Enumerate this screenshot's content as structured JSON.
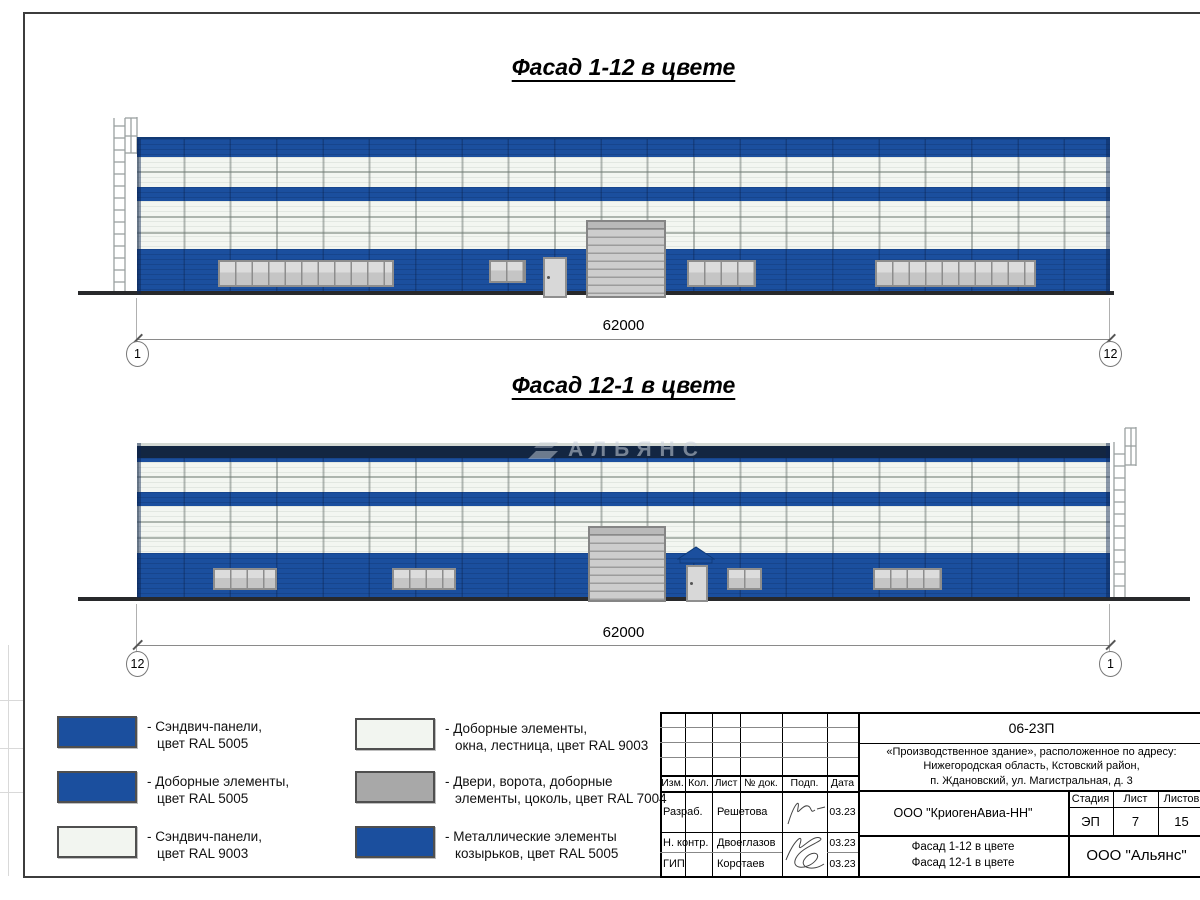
{
  "facades": [
    {
      "title": "Фасад 1-12 в цвете",
      "dimension": "62000",
      "axis_left": "1",
      "axis_right": "12"
    },
    {
      "title": "Фасад 12-1 в цвете",
      "dimension": "62000",
      "axis_left": "12",
      "axis_right": "1"
    }
  ],
  "watermark": "АЛЬЯНС",
  "legend": {
    "items": [
      {
        "label": "- Сэндвич-панели,\nцвет RAL 5005",
        "color": "#1b4f9e"
      },
      {
        "label": "- Доборные элементы,\nцвет RAL 5005",
        "color": "#1b4f9e"
      },
      {
        "label": "- Сэндвич-панели,\nцвет RAL 9003",
        "color": "#f2f5f0"
      },
      {
        "label": "- Доборные элементы,\nокна, лестница, цвет RAL 9003",
        "color": "#f2f5f0"
      },
      {
        "label": "- Двери, ворота, доборные\nэлементы, цоколь, цвет RAL 7004",
        "color": "#a8a8a8"
      },
      {
        "label": "- Металлические элементы\nкозырьков, цвет RAL 5005",
        "color": "#1b4f9e"
      }
    ]
  },
  "title_block": {
    "doc_number": "06-23П",
    "project": "«Производственное здание», расположенное по адресу:\nНижегородская область, Кстовский район,\nп. Ждановский, ул. Магистральная, д. 3",
    "company": "ООО \"КриогенАвиа-НН\"",
    "drawing_title": "Фасад 1-12 в цвете\nФасад 12-1 в цвете",
    "org": "ООО \"Альянс\"",
    "stage_label": "Стадия",
    "sheet_label": "Лист",
    "sheets_label": "Листов",
    "stage": "ЭП",
    "sheet": "7",
    "sheets": "15",
    "header": [
      "Изм.",
      "Кол.",
      "Лист",
      "№ док.",
      "Подп.",
      "Дата"
    ],
    "rows": [
      {
        "role": "Разраб.",
        "name": "Решетова",
        "date": "03.23"
      },
      {
        "role": "Н. контр.",
        "name": "Двоеглазов",
        "date": "03.23"
      },
      {
        "role": "ГИП",
        "name": "Коротаев",
        "date": "03.23"
      }
    ]
  }
}
